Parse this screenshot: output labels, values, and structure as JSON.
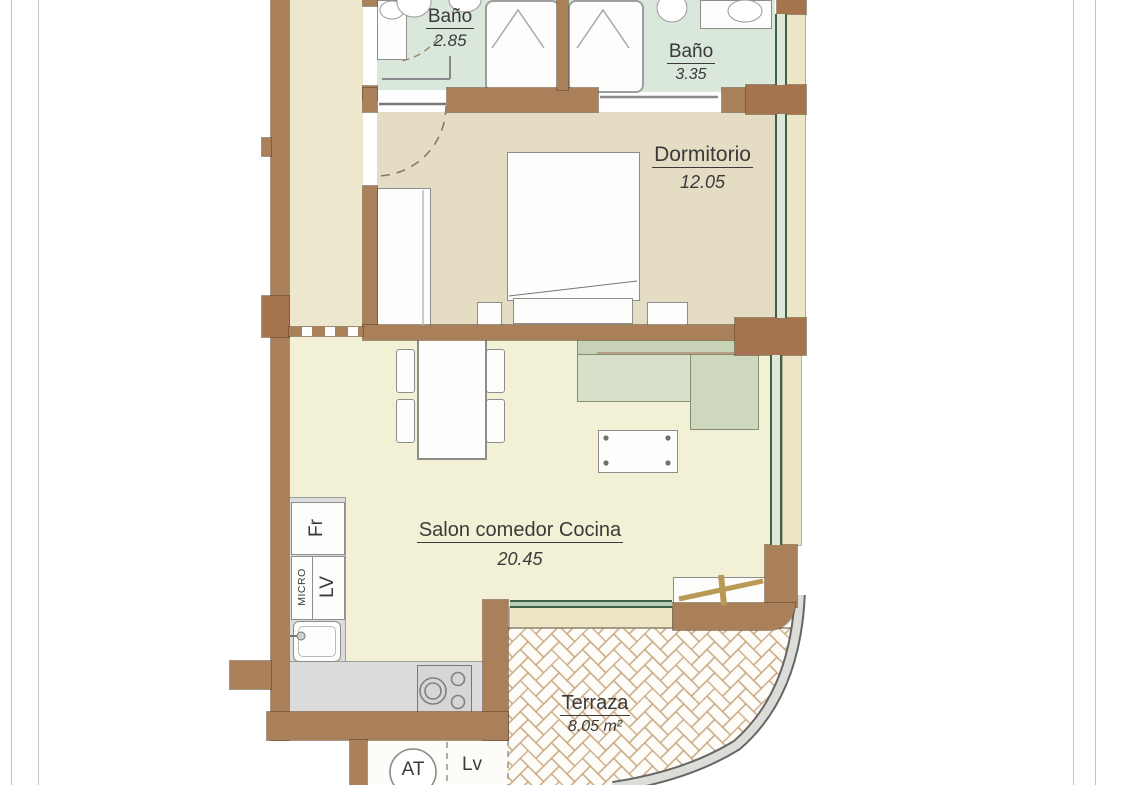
{
  "plan_title": "Apartment floor plan",
  "rooms": {
    "bathroom_1": {
      "label": "Baño",
      "area": "2.85"
    },
    "bathroom_2": {
      "label": "Baño",
      "area": "3.35"
    },
    "bedroom": {
      "label": "Dormitorio",
      "area": "12.05"
    },
    "living": {
      "label": "Salon comedor Cocina",
      "area": "20.45"
    },
    "terrace": {
      "label": "Terraza",
      "area": "8.05 m²"
    }
  },
  "kitchen": {
    "fridge_label": "Fr",
    "dishwasher_label": "LV",
    "microwave_label": "MICRO"
  },
  "utility": {
    "water_heater_label": "AT",
    "washing_machine_label": "Lv"
  },
  "colors": {
    "wall": "#a9805a",
    "pillar": "#a5744f",
    "bath_floor": "#dae7db",
    "bedroom_floor": "#e4ddc4",
    "hall_floor": "#ece7cd",
    "living_floor": "#f3f1d5",
    "sill": "#ece5c6",
    "counter": "#dcdcdc",
    "window_green": "#41604a",
    "tile_grout": "#c9a87e",
    "sofa": "#d9e0ca",
    "text": "#3a3a3a"
  }
}
